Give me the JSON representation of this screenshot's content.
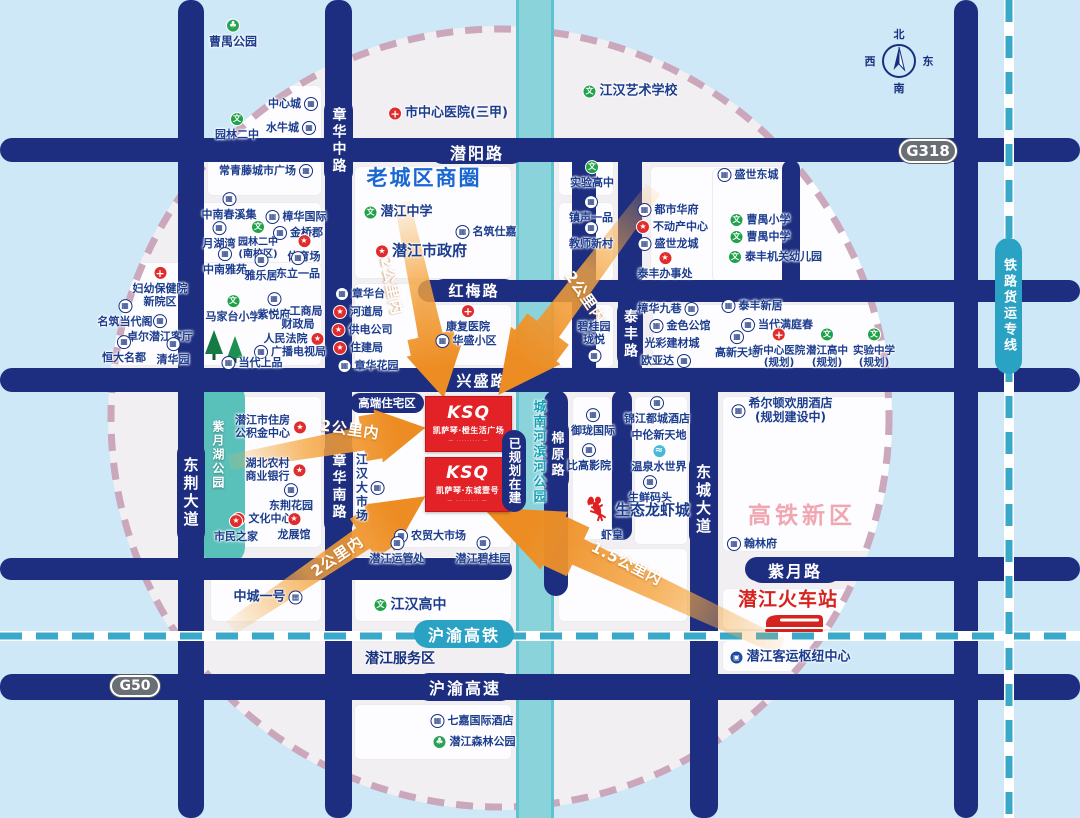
{
  "colors": {
    "road_navy": "#1d2e80",
    "river_teal": "#8ad3db",
    "rail_teal": "#2aa2c4",
    "ring_pink": "#c79fb6",
    "arrow_orange": "#ed8c22",
    "project_red": "#e32227",
    "label_navy": "#1c3c8e",
    "old_town_blue": "#1a67d2",
    "hsr_pink": "#f0a7b2",
    "station_red": "#d5231f"
  },
  "map": {
    "compass": {
      "n": "北",
      "e": "东",
      "s": "南",
      "w": "西"
    },
    "zones": {
      "old_town": "老城区商圈",
      "hsr_district": "高铁新区",
      "residential": "高端住宅区",
      "planned": "已规划在建"
    },
    "roads": {
      "zhanghua_mid": "章华中路",
      "zhanghua_south": "章华南路",
      "dongjing": "东荆大道",
      "qianyang": "潜阳路",
      "hongmei": "红梅路",
      "xingsheng": "兴盛路",
      "taifeng": "泰丰路",
      "mianyuan": "棉原路",
      "dongcheng": "东城大道",
      "ziyue": "紫月路",
      "expressway": "沪渝高速"
    },
    "rails": {
      "hsr": "沪渝高铁",
      "freight": "铁路货运专线"
    },
    "highways": {
      "g318": "G318",
      "g50": "G50"
    },
    "station": {
      "rail_station": "潜江火车站"
    },
    "service_area": "潜江服务区",
    "project": {
      "logo": "KSQ",
      "box1_name": "凯萨琴·橙生活广场",
      "box2_name": "凯萨琴·东城壹号",
      "tagline": "— ········· —"
    },
    "icon_glyphs": {
      "bld": "▦",
      "cart": "▦",
      "star": "★",
      "cross": "+",
      "school": "文",
      "park": "♣",
      "water": "≈",
      "bus": "▣"
    },
    "arrows": [
      {
        "label": "2公里内",
        "x": 423,
        "y": 300,
        "len": 200,
        "h": 56,
        "rot": 78,
        "lx": 392,
        "ly": 286,
        "lrot": 78
      },
      {
        "label": "2公里内",
        "x": 576,
        "y": 292,
        "len": 258,
        "h": 62,
        "rot": 127,
        "lx": 586,
        "ly": 297,
        "lrot": 55
      },
      {
        "label": "2公里内",
        "x": 327,
        "y": 445,
        "len": 200,
        "h": 54,
        "rot": -10,
        "lx": 350,
        "ly": 429,
        "lrot": 8
      },
      {
        "label": "2公里内",
        "x": 328,
        "y": 562,
        "len": 235,
        "h": 56,
        "rot": -34,
        "lx": 337,
        "ly": 556,
        "lrot": -34
      },
      {
        "label": "1.5公里内",
        "x": 632,
        "y": 577,
        "len": 330,
        "h": 64,
        "rot": 205,
        "lx": 627,
        "ly": 563,
        "lrot": 27
      }
    ],
    "pois": [
      {
        "t": "曹禺公园",
        "ic": "park",
        "ip": "top",
        "x": 233,
        "y": 34,
        "fs": 12,
        "b": 1
      },
      {
        "t": "中心城",
        "ic": "bld",
        "ip": "right",
        "x": 293,
        "y": 104
      },
      {
        "t": "园林二中",
        "ic": "school",
        "ip": "top",
        "x": 237,
        "y": 127
      },
      {
        "t": "水牛城",
        "ic": "bld",
        "ip": "right",
        "x": 291,
        "y": 128
      },
      {
        "t": "常青藤城市广场",
        "ic": "bld",
        "ip": "right",
        "x": 266,
        "y": 171
      },
      {
        "t": "中南春溪集",
        "ic": "bld",
        "ip": "top",
        "x": 229,
        "y": 207
      },
      {
        "t": "樟华国际",
        "ic": "bld",
        "ip": "left",
        "x": 296,
        "y": 217
      },
      {
        "t": "月湖湾",
        "ic": "bld",
        "ip": "top",
        "x": 219,
        "y": 236
      },
      {
        "t": "园林二中",
        "l2": "(南校区)",
        "ic": "school",
        "ip": "top",
        "x": 258,
        "y": 240,
        "fs": 10
      },
      {
        "t": "金桥郡",
        "ic": "bld",
        "ip": "left",
        "x": 298,
        "y": 233
      },
      {
        "t": "体育场",
        "ic": "star",
        "ip": "top",
        "x": 304,
        "y": 249
      },
      {
        "t": "中南雅苑",
        "ic": "bld",
        "ip": "top",
        "x": 225,
        "y": 262
      },
      {
        "t": "雅乐居",
        "ic": "bld",
        "ip": "top",
        "x": 261,
        "y": 268
      },
      {
        "t": "东立一品",
        "ic": "bld",
        "ip": "top",
        "x": 298,
        "y": 266
      },
      {
        "t": "妇幼保健院",
        "l2": "新院区",
        "ic": "cross",
        "ip": "top",
        "x": 160,
        "y": 287
      },
      {
        "t": "名筑当代阁",
        "ic": "bld",
        "ip": "top",
        "x": 125,
        "y": 314
      },
      {
        "t": "卓尔潜江客厅",
        "ic": "bld",
        "ip": "top",
        "x": 160,
        "y": 329
      },
      {
        "t": "恒大名都",
        "ic": "bld",
        "ip": "top",
        "x": 124,
        "y": 350
      },
      {
        "t": "清华园",
        "ic": "bld",
        "ip": "top",
        "x": 173,
        "y": 352
      },
      {
        "t": "马家台小学",
        "ic": "school",
        "ip": "top",
        "x": 233,
        "y": 309
      },
      {
        "t": "紫悦府",
        "ic": "bld",
        "ip": "top",
        "x": 274,
        "y": 307
      },
      {
        "t": "工商局",
        "x": 306,
        "y": 312
      },
      {
        "t": "财政局",
        "x": 298,
        "y": 325
      },
      {
        "t": "人民法院",
        "ic": "star",
        "ip": "right",
        "x": 294,
        "y": 339
      },
      {
        "t": "广播电视局",
        "ic": "bld",
        "ip": "left",
        "x": 290,
        "y": 352
      },
      {
        "t": "当代上品",
        "ic": "bld",
        "ip": "left",
        "x": 252,
        "y": 363
      },
      {
        "t": "市中心医院(三甲)",
        "ic": "cross",
        "ip": "left",
        "x": 448,
        "y": 114,
        "fs": 13,
        "b": 1
      },
      {
        "t": "江汉艺术学校",
        "ic": "school",
        "ip": "left",
        "x": 630,
        "y": 92,
        "fs": 13,
        "b": 1
      },
      {
        "t": "实验高中",
        "ic": "school",
        "ip": "top",
        "x": 592,
        "y": 175
      },
      {
        "t": "潜江中学",
        "ic": "school",
        "ip": "left",
        "x": 398,
        "y": 213,
        "fs": 13,
        "b": 1
      },
      {
        "t": "名筑仕嘉",
        "ic": "bld",
        "ip": "left",
        "x": 486,
        "y": 232
      },
      {
        "t": "潜江市政府",
        "ic": "star",
        "ip": "left",
        "x": 421,
        "y": 251,
        "fs": 15,
        "b": 1
      },
      {
        "t": "镇声一品",
        "ic": "bld",
        "ip": "top",
        "x": 591,
        "y": 210
      },
      {
        "t": "教师新村",
        "ic": "bld",
        "ip": "top",
        "x": 591,
        "y": 236
      },
      {
        "t": "都市华府",
        "ic": "bld",
        "ip": "left",
        "x": 668,
        "y": 210
      },
      {
        "t": "不动产中心",
        "ic": "star",
        "ip": "left",
        "x": 672,
        "y": 227
      },
      {
        "t": "盛世龙城",
        "ic": "bld",
        "ip": "left",
        "x": 668,
        "y": 244
      },
      {
        "t": "泰丰办事处",
        "ic": "star",
        "ip": "top",
        "x": 665,
        "y": 266
      },
      {
        "t": "章华台",
        "ic": "bld",
        "ip": "left",
        "x": 360,
        "y": 294
      },
      {
        "t": "河道局",
        "ic": "star",
        "ip": "left",
        "x": 358,
        "y": 312
      },
      {
        "t": "供电公司",
        "ic": "star",
        "ip": "left",
        "x": 362,
        "y": 330
      },
      {
        "t": "住建局",
        "ic": "star",
        "ip": "left",
        "x": 358,
        "y": 348
      },
      {
        "t": "章华花园",
        "ic": "bld",
        "ip": "left",
        "x": 368,
        "y": 366
      },
      {
        "t": "康复医院",
        "ic": "cross",
        "ip": "top",
        "x": 468,
        "y": 319
      },
      {
        "t": "华盛小区",
        "ic": "bld",
        "ip": "left",
        "x": 466,
        "y": 341
      },
      {
        "t": "盛世东城",
        "ic": "bld",
        "ip": "left",
        "x": 748,
        "y": 175
      },
      {
        "t": "曹禺小学",
        "ic": "school",
        "ip": "left",
        "x": 760,
        "y": 220
      },
      {
        "t": "曹禺中学",
        "ic": "school",
        "ip": "left",
        "x": 760,
        "y": 237
      },
      {
        "t": "泰丰机关幼儿园",
        "ic": "school",
        "ip": "left",
        "x": 775,
        "y": 257
      },
      {
        "t": "泰丰新居",
        "ic": "bld",
        "ip": "left",
        "x": 752,
        "y": 306
      },
      {
        "t": "当代满庭春",
        "ic": "bld",
        "ip": "left",
        "x": 777,
        "y": 325
      },
      {
        "t": "高新天地",
        "ic": "bld",
        "ip": "top",
        "x": 737,
        "y": 345
      },
      {
        "t": "新中心医院",
        "l2": "(规划)",
        "ic": "cross",
        "ip": "top",
        "x": 779,
        "y": 348,
        "fs": 10.5
      },
      {
        "t": "潜江高中",
        "l2": "(规划)",
        "ic": "school",
        "ip": "top",
        "x": 827,
        "y": 348,
        "fs": 10.5
      },
      {
        "t": "实验中学",
        "l2": "(规划)",
        "ic": "school",
        "ip": "top",
        "x": 874,
        "y": 348,
        "fs": 10.5
      },
      {
        "t": "希尔顿欢朋酒店",
        "l2": "(规划建设中)",
        "ic": "bld",
        "ip": "left",
        "x": 782,
        "y": 411,
        "fs": 12,
        "b": 1
      },
      {
        "t": "翰林府",
        "ic": "bld",
        "ip": "left",
        "x": 752,
        "y": 544
      },
      {
        "t": "樟华九巷",
        "ic": "bld",
        "ip": "right",
        "x": 668,
        "y": 309
      },
      {
        "t": "金色公馆",
        "ic": "bld",
        "ip": "left",
        "x": 680,
        "y": 326
      },
      {
        "t": "光彩建材城",
        "x": 672,
        "y": 344
      },
      {
        "t": "欧亚达",
        "ic": "cart",
        "ip": "right",
        "x": 666,
        "y": 361
      },
      {
        "t": "碧桂园",
        "l2": "珑悦",
        "ic": "bld",
        "ip": "bottom",
        "x": 594,
        "y": 342
      },
      {
        "t": "御珑国际",
        "ic": "bld",
        "ip": "top",
        "x": 593,
        "y": 423
      },
      {
        "t": "锦江都城酒店",
        "ic": "bld",
        "ip": "top",
        "x": 657,
        "y": 411
      },
      {
        "t": "中伦新天地",
        "x": 659,
        "y": 436
      },
      {
        "t": "比高影院",
        "ic": "bld",
        "ip": "top",
        "x": 589,
        "y": 458
      },
      {
        "t": "温泉水世界",
        "ic": "water",
        "ip": "top",
        "x": 659,
        "y": 459
      },
      {
        "t": "生鲜码头",
        "ic": "bld",
        "ip": "top",
        "x": 650,
        "y": 490
      },
      {
        "t": "生态龙虾城",
        "ic": "lobster",
        "ip": "left",
        "x": 637,
        "y": 511,
        "fs": 15,
        "b": 1
      },
      {
        "t": "虾皇",
        "x": 612,
        "y": 536
      },
      {
        "t": "潜江市住房",
        "l2": "公积金中心",
        "ic": "star",
        "ip": "right",
        "x": 271,
        "y": 427
      },
      {
        "t": "湖北农村",
        "l2": "商业银行",
        "ic": "star",
        "ip": "right",
        "x": 276,
        "y": 470
      },
      {
        "t": "东荆花园",
        "ic": "bld",
        "ip": "top",
        "x": 291,
        "y": 498
      },
      {
        "t": "文化中心",
        "ic": "star",
        "ip": "left",
        "x": 262,
        "y": 519
      },
      {
        "t": "市民之家",
        "ic": "star",
        "ip": "top",
        "x": 236,
        "y": 529
      },
      {
        "t": "龙展馆",
        "ic": "star",
        "ip": "top",
        "x": 294,
        "y": 527
      },
      {
        "t": "中城一号",
        "ic": "bld",
        "ip": "right",
        "x": 268,
        "y": 598,
        "fs": 13,
        "b": 1
      },
      {
        "t": "江汉大市场",
        "ic": "bld",
        "ip": "right",
        "x": 369,
        "y": 488,
        "vert": 1,
        "fs": 12,
        "b": 1
      },
      {
        "t": "农贸大市场",
        "ic": "bld",
        "ip": "left",
        "x": 430,
        "y": 536
      },
      {
        "t": "潜江运管处",
        "ic": "bld",
        "ip": "top",
        "x": 397,
        "y": 551
      },
      {
        "t": "潜江碧桂园",
        "ic": "bld",
        "ip": "top",
        "x": 483,
        "y": 551
      },
      {
        "t": "江汉高中",
        "ic": "school",
        "ip": "left",
        "x": 410,
        "y": 605,
        "fs": 14,
        "b": 1
      },
      {
        "t": "七嘉国际酒店",
        "ic": "bld",
        "ip": "left",
        "x": 472,
        "y": 721
      },
      {
        "t": "潜江森林公园",
        "ic": "park",
        "ip": "left",
        "x": 474,
        "y": 742
      },
      {
        "t": "潜江客运枢纽中心",
        "ic": "bus",
        "ip": "left",
        "x": 790,
        "y": 658,
        "fs": 13,
        "b": 1
      },
      {
        "t": "紫月湖公园",
        "x": 217,
        "y": 455,
        "vert": 1,
        "fs": 12,
        "b": 1,
        "cls": "poi-white"
      },
      {
        "t": "城南河滨河公园",
        "x": 537,
        "y": 452,
        "vert": 1,
        "fs": 13,
        "b": 1,
        "cls": "poi-teal"
      }
    ]
  }
}
